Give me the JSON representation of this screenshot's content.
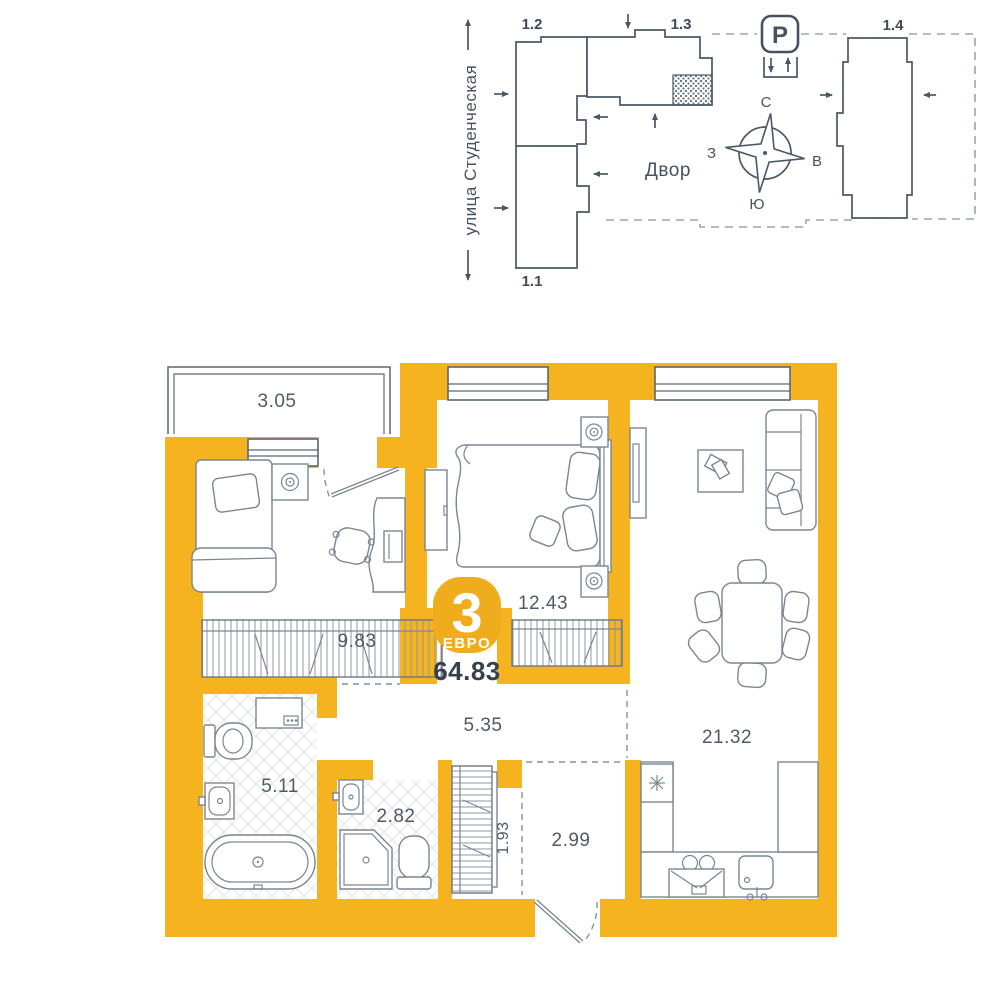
{
  "site": {
    "street": "улица Студенческая",
    "courtyard": "Двор",
    "parking": "P",
    "buildings": {
      "b11": "1.1",
      "b12": "1.2",
      "b13": "1.3",
      "b14": "1.4"
    },
    "compass": {
      "north": "С",
      "south": "Ю",
      "west": "З",
      "east": "В"
    }
  },
  "plan": {
    "badge": {
      "rooms": "3",
      "type": "ЕВРО"
    },
    "total_area": "64.83",
    "areas": {
      "balcony": "3.05",
      "bedroom": "9.83",
      "master_bedroom": "12.43",
      "living_kitchen": "21.32",
      "hallway": "5.35",
      "bathroom": "5.11",
      "toilet": "2.82",
      "wardrobe": "1.93",
      "entry": "2.99"
    }
  },
  "colors": {
    "wall": "#F5B320",
    "badge": "#EFAC1C",
    "line": "#4A5866",
    "text": "#46525F"
  }
}
